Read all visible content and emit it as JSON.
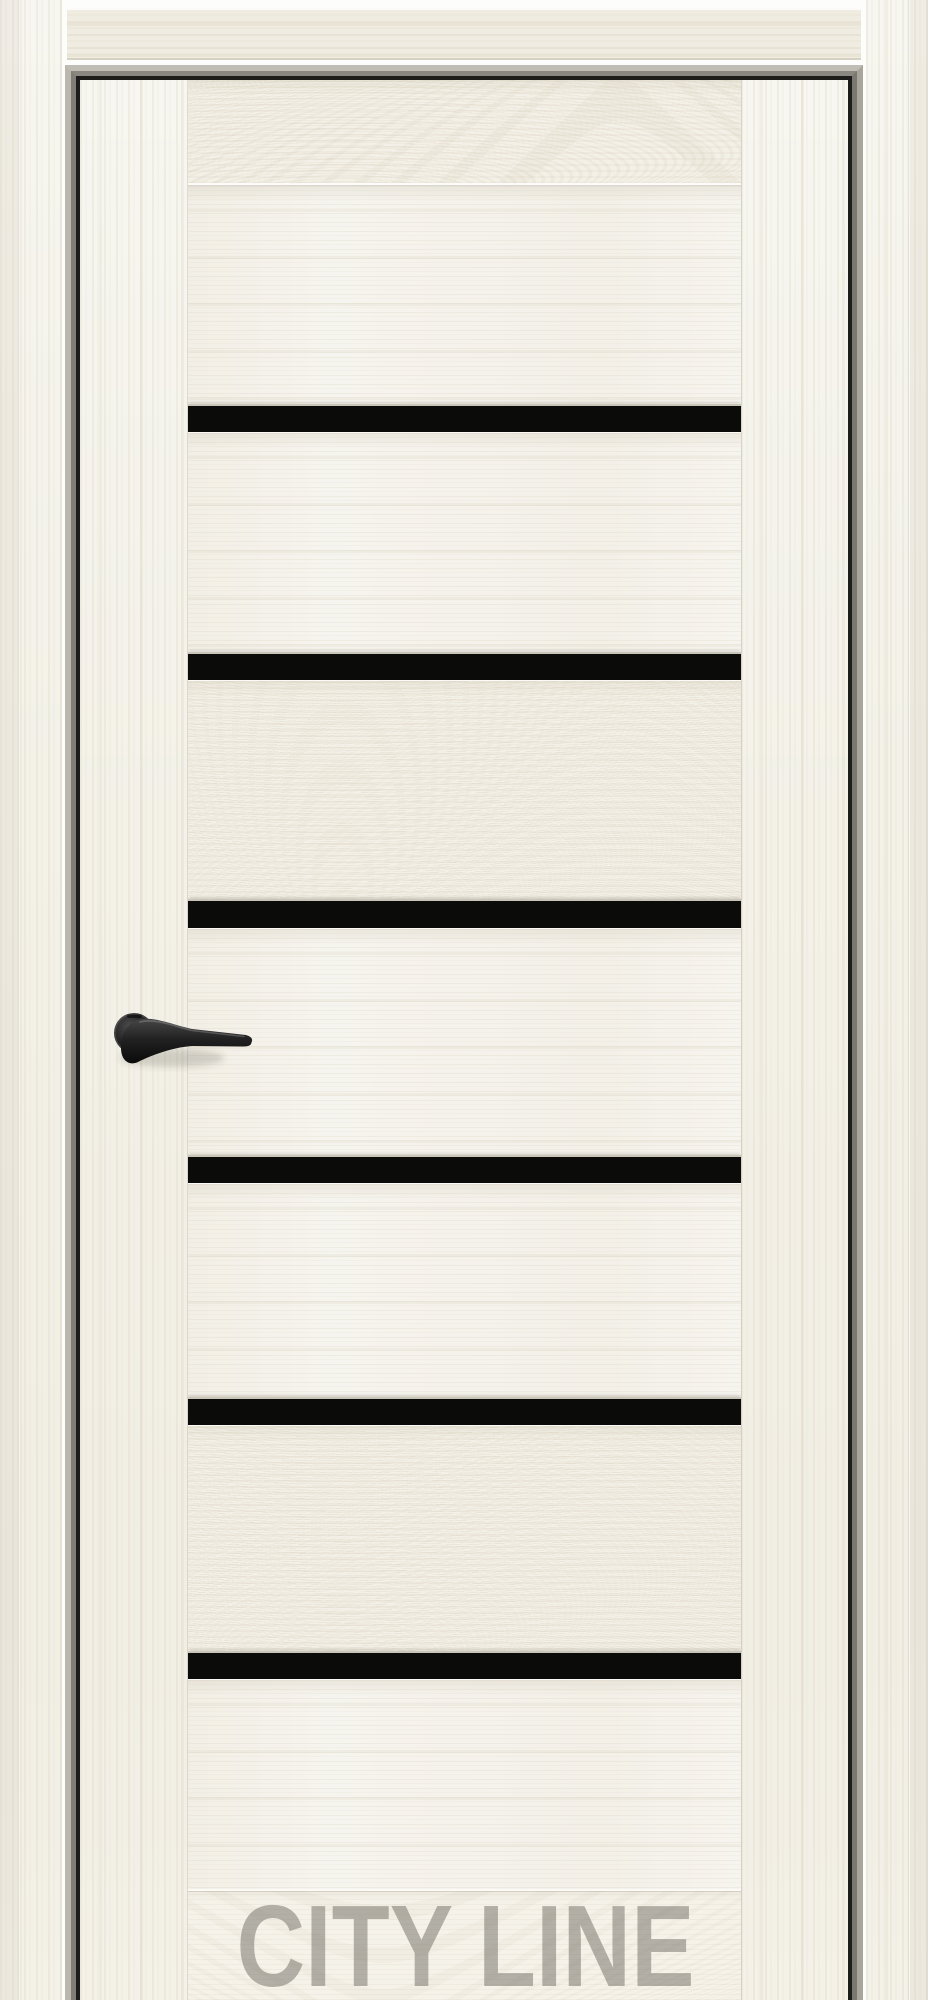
{
  "watermark": {
    "text": "CITY LINE"
  },
  "door": {
    "type": "interior-door-product-photo",
    "glass_stripe_count": 6,
    "colors": {
      "wood_base": "#f5f3ec",
      "wood_grain": "#d9d2bf",
      "glass_stripe_black": "#0b0b09",
      "frame_metal_gray": "#a8a59d",
      "frame_shadow_gap": "#1d1d1b",
      "handle_black": "#1b1b1b",
      "watermark_gray": "#8f8e86"
    },
    "center_rows": [
      {
        "type": "board",
        "h": 106,
        "variant": "swirl",
        "toprail": true
      },
      {
        "type": "board",
        "h": 218,
        "variant": "plain"
      },
      {
        "type": "stripe",
        "h": 29
      },
      {
        "type": "board",
        "h": 219,
        "variant": "plain"
      },
      {
        "type": "stripe",
        "h": 29
      },
      {
        "type": "board",
        "h": 218,
        "variant": "swirl"
      },
      {
        "type": "stripe",
        "h": 30
      },
      {
        "type": "board",
        "h": 226,
        "variant": "plain"
      },
      {
        "type": "stripe",
        "h": 29
      },
      {
        "type": "board",
        "h": 213,
        "variant": "plain"
      },
      {
        "type": "stripe",
        "h": 29
      },
      {
        "type": "board",
        "h": 225,
        "variant": "swirl"
      },
      {
        "type": "stripe",
        "h": 29
      },
      {
        "type": "board",
        "h": 209,
        "variant": "plain"
      },
      {
        "type": "board",
        "h": 110,
        "variant": "rail",
        "flex": true
      }
    ]
  }
}
